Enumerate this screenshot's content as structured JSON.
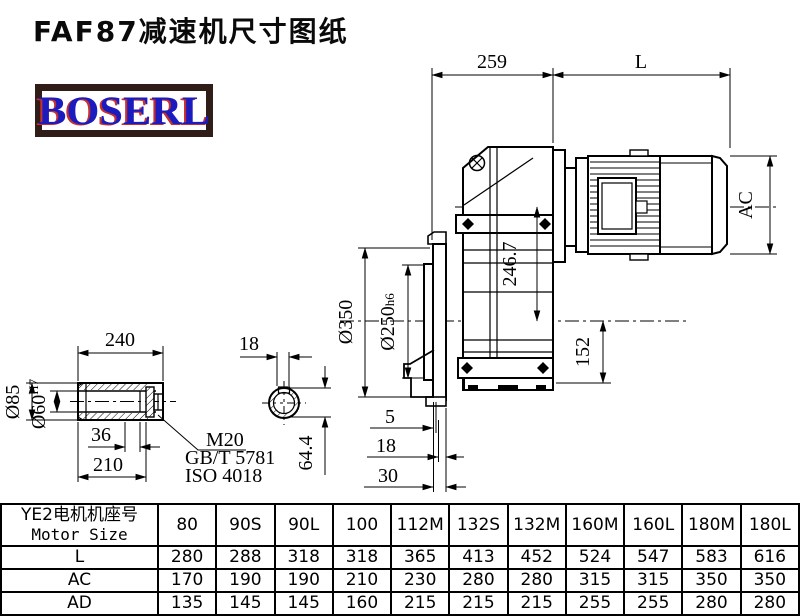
{
  "title": "FAF87减速机尺寸图纸",
  "logo": {
    "text": "BOSERL"
  },
  "drawing": {
    "top_dims": {
      "width": "259",
      "motor_length": "L"
    },
    "main_dims": {
      "axis_offset": "246.7",
      "flange_od": "Ø350",
      "spigot_main": "Ø250",
      "spigot_fit": "h6",
      "below_axis": "152",
      "motor_dia": "AC",
      "offset_5": "5",
      "offset_18": "18",
      "offset_30": "30"
    },
    "shaft_dims": {
      "length": "240",
      "outer_dia": "Ø85",
      "bore_main": "Ø60",
      "bore_fit": "H7",
      "depth": "36",
      "usable_length": "210",
      "key_width": "18",
      "key_depth": "64.4"
    },
    "bolt_note": {
      "line1": "M20",
      "line2": "GB/T 5781",
      "line3": "ISO 4018"
    }
  },
  "table": {
    "header_cn": "YE2电机机座号",
    "header_en": "Motor Size",
    "columns": [
      "80",
      "90S",
      "90L",
      "100",
      "112M",
      "132S",
      "132M",
      "160M",
      "160L",
      "180M",
      "180L"
    ],
    "rows": [
      {
        "label": "L",
        "values": [
          "280",
          "288",
          "318",
          "318",
          "365",
          "413",
          "452",
          "524",
          "547",
          "583",
          "616"
        ]
      },
      {
        "label": "AC",
        "values": [
          "170",
          "190",
          "190",
          "210",
          "230",
          "280",
          "280",
          "315",
          "315",
          "350",
          "350"
        ]
      },
      {
        "label": "AD",
        "values": [
          "135",
          "145",
          "145",
          "160",
          "215",
          "215",
          "215",
          "255",
          "255",
          "280",
          "280"
        ]
      }
    ]
  }
}
